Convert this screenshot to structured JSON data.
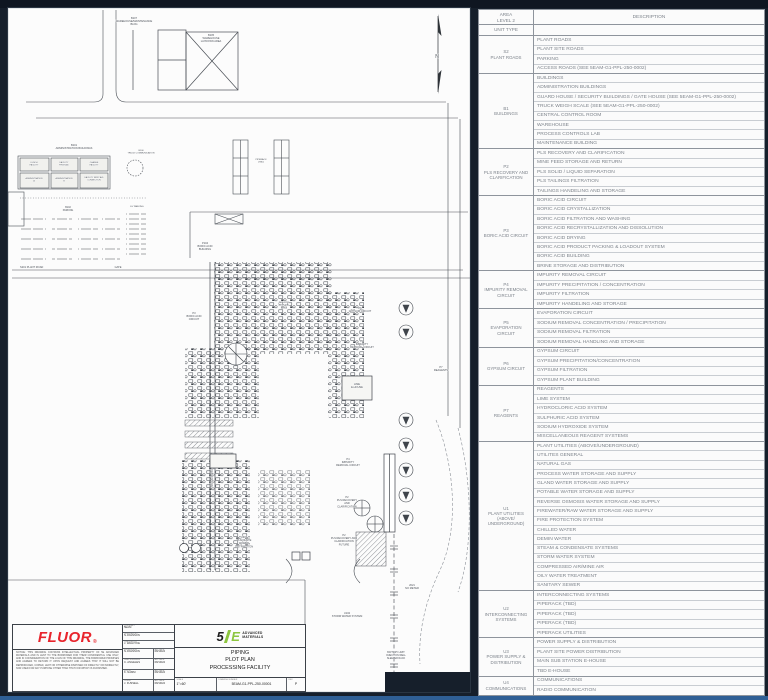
{
  "colors": {
    "background": "#161f2b",
    "sheet": "#fcfcfc",
    "bottom_accent": "#2f5f95",
    "fluor_red": "#e8242c",
    "logo_green": "#8dc63f"
  },
  "legend": {
    "header": {
      "area_line1": "AREA",
      "area_line2": "LEVEL 2",
      "unit_type": "UNIT TYPE",
      "description": "DESCRIPTION"
    },
    "groups": [
      {
        "code": "S2",
        "name": "PLANT ROADS",
        "items": [
          "PLANT ROADS",
          "PLANT SITE ROADS",
          "PARKING",
          "ACCESS ROADS (SEE 5EAM-G1-PPL-250-0002)"
        ]
      },
      {
        "code": "B1",
        "name": "BUILDINGS",
        "items": [
          "BUILDINGS",
          "ADMINISTRATION BUILDINGS",
          "GUARD HOUSE / SECURITY BUILDINGS / GATE HOUSE (SEE 5EAM-G1-PPL-250-0002)",
          "TRUCK WEIGH SCALE (SEE 5EAM-G1-PPL-250-0002)",
          "CENTRAL CONTROL ROOM",
          "WAREHOUSE",
          "PROCESS CONTROLS LAB",
          "MAINTENANCE BUILDING"
        ]
      },
      {
        "code": "P2",
        "name": "PLS RECOVERY AND CLARIFICATION",
        "items": [
          "PLS RECOVERY AND CLARIFICATION",
          "MINE FEED STORAGE AND RETURN",
          "PLS SOLID / LIQUID SEPARATION",
          "PLS TAILINGS FILTRATION",
          "TAILINGS HANDELING AND STORAGE"
        ]
      },
      {
        "code": "P3",
        "name": "BORIC ACID CIRCUIT",
        "items": [
          "BORIC ACID CIRCUIT",
          "BORIC ACID CRYSTALLIZATION",
          "BORIC ACID FILTRATION AND WASHING",
          "BORIC ACID RECRYSTALLIZATION AND DISSOLUTION",
          "BORIC ACID DRYING",
          "BORIC ACID PRODUCT PACKING & LOADOUT SYSTEM",
          "BORIC ACID BUILDING",
          "BRINE STORAGE AND DISTRIBUTION"
        ]
      },
      {
        "code": "P4",
        "name": "IMPURITY REMOVAL CIRCUIT",
        "items": [
          "IMPURITY REMOVAL CIRCUIT",
          "IMPURITY PRECIPITATION / CONCENTRATION",
          "IMPURITY FILTRATION",
          "IMPURITY HANDELING AND STORAGE"
        ]
      },
      {
        "code": "P5",
        "name": "EVAPORATION CIRCUIT",
        "items": [
          "EVAPORATION CIRCUIT",
          "SODIUM REMOVAL CONCENTRATION / PRECIPITATION",
          "SODIUM REMOVAL FILTRATION",
          "SODIUM REMOVAL HANDLING AND STORAGE"
        ]
      },
      {
        "code": "P6",
        "name": "GYPSUM CIRCUIT",
        "items": [
          "GYPSUM CIRCUIT",
          "GYPSUM PRECIPITATION/CONCENTRATION",
          "GYPSUM FILTRATION",
          "GYPSUM PLANT BUILDING"
        ]
      },
      {
        "code": "P7",
        "name": "REAGENTS",
        "items": [
          "REAGENTS",
          "LIME SYSTEM",
          "HYDROCLORIC ACID SYSTEM",
          "SULPHURIC ACID SYSTEM",
          "SODIUM HYDROXIDE SYSTEM",
          "MISCELLANEOUS REAGENT SYSTEMS"
        ]
      },
      {
        "code": "U1",
        "name": "PLANT UTILITIES (ABOVE/ UNDERGROUND)",
        "items": [
          "PLANT UTILITIES (ABOVE/UNDERGROUND)",
          "UTILITES GENERAL",
          "NATURAL GAS",
          "PROCESS WATER STORAGE AND SUPPLY",
          "GLAND WATER STORAGE AND SUPPLY",
          "POTABLE WATER STORAGE AND SUPPLY",
          "REVERSE OSMOSIS WATER STORAGE AND SUPPLY",
          "FIREWATER/RAW WATER STORAGE AND SUPPLY",
          "FIRE PROTECTION SYSTEM",
          "CHILLED WATER",
          "DEMIN WATER",
          "STEAM & CONDENSATE SYSTEMS",
          "STORM WATER SYSTEM",
          "COMPRESSED AIR/MINE AIR",
          "OILY WATER TREATMENT",
          "SANITARY SEWER"
        ]
      },
      {
        "code": "U2",
        "name": "INTERCONNECTING SYSTEMS",
        "items": [
          "INTERCONNECTING SYSTEMS",
          "PIPERACK (TBD)",
          "PIPERACK (TBD)",
          "PIPERACK  (TBD)",
          "PIPERACK UTILITIES"
        ]
      },
      {
        "code": "U3",
        "name": "POWER SUPPLY & DISTRIBUTION",
        "items": [
          "POWER SUPPLY & DISTRIBUTION",
          "PLANT SITE POWER DISTRIBUTION",
          "MAIN SUB STATION E-HOUSE",
          "TBD E-HOUSE"
        ]
      },
      {
        "code": "U4",
        "name": "COMMUNICATIONS",
        "items": [
          "COMMUNICATIONS",
          "RADIO COMMUNICATION"
        ]
      }
    ]
  },
  "title_block": {
    "fluor_logo": "FLUOR",
    "fluor_mark": "®",
    "notice": "NOTICE: THIS DRAWING CONTAINS INTELLECTUAL PROPERTY OF 5E ADVANCED MATERIALS AND IS LENT TO THE BORROWER FOR THEIR CONFIDENTIAL USE ONLY, AND IN CONSIDERATION OF THE LOAN OF THIS DRAWING, THE BORROWER PROMISES AND AGREES TO RETURN IT UPON REQUEST AND AGREES THAT IT WILL NOT BE REPRODUCED, COPIED, LENT OR OTHERWISE DISPOSED OF DIRECTLY OR INDIRECTLY, NOR USED FOR ANY PURPOSE OTHER THAN THAT FOR WHICH IS FURNISHED.",
    "contract_label": "CONTRACT",
    "contract_value": "5EAM",
    "designed_label": "DESIGNED BY",
    "designed_value": "N.JOHNSON",
    "checked_label": "CHECKED BY",
    "checked_value": "J. WALDYKE",
    "approvals": [
      {
        "role": "SUPERVISOR",
        "name": "N.JOHNSON",
        "date_label": "APP DATE",
        "date": "08/19/24"
      },
      {
        "role": "LEAD ENGINEER",
        "name": "C. ANGELES",
        "date_label": "APP DATE",
        "date": "08/19/24"
      },
      {
        "role": "FLUOR",
        "name": "K. NAMM",
        "date_label": "APP DATE",
        "date": "08/19/24"
      },
      {
        "role": "CLIENT",
        "name": "J. FUSSELL",
        "date_label": "APP DATE",
        "date": "08/19/24"
      }
    ],
    "logo_5": "5",
    "logo_E": "E",
    "logo_adv_line1": "ADVANCED",
    "logo_adv_line2": "MATERIALS",
    "title_line1": "PIPING",
    "title_line2": "PLOT PLAN",
    "title_line3": "PROCESSING FACILITY",
    "scale_label": "SCALE",
    "scale_value": "1\"=60'",
    "number_label": "DRAWING NUMBER",
    "number_value": "5EAM-G1-PPL-250-00001",
    "rev_label": "REV",
    "rev_value": "P"
  },
  "drawing": {
    "labels": [
      {
        "x": 126,
        "y": 11,
        "s": 2.6,
        "lines": [
          "B107",
          "WAREHOUSE/MAINTENANCE",
          "BLDG"
        ]
      },
      {
        "x": 203,
        "y": 28,
        "s": 2.6,
        "lines": [
          "B105",
          "WAREHOUSE",
          "LAYDOWN AREA"
        ]
      },
      {
        "x": 66,
        "y": 138,
        "s": 2.6,
        "lines": [
          "B101",
          "ADMINISTRATION BUILDINGS"
        ]
      },
      {
        "x": 26,
        "y": 155,
        "s": 2,
        "lines": [
          "LUNCH",
          "FACILITY"
        ]
      },
      {
        "x": 56,
        "y": 155,
        "s": 2,
        "lines": [
          "FACILITY",
          "FIRST AID"
        ]
      },
      {
        "x": 86,
        "y": 155,
        "s": 2,
        "lines": [
          "CHANGE",
          "FACILITY"
        ]
      },
      {
        "x": 26,
        "y": 171,
        "s": 2,
        "lines": [
          "ADMINISTRATION",
          "A"
        ]
      },
      {
        "x": 56,
        "y": 171,
        "s": 2,
        "lines": [
          "ADMINISTRATION",
          "B"
        ]
      },
      {
        "x": 86,
        "y": 170,
        "s": 2,
        "lines": [
          "FACILITY FIRST AID",
          "CONNECTION"
        ]
      },
      {
        "x": 133,
        "y": 143,
        "s": 2.2,
        "lines": [
          "B106",
          "TRUCK COMMUNICATION"
        ]
      },
      {
        "x": 129,
        "y": 199,
        "s": 2.2,
        "lines": [
          "EV PARKING"
        ]
      },
      {
        "x": 60,
        "y": 200,
        "s": 2.4,
        "lines": [
          "B102",
          "PARKING"
        ]
      },
      {
        "x": 12,
        "y": 260,
        "s": 2.6,
        "anchor": "start",
        "lines": [
          "S201 PLANT ROAD"
        ]
      },
      {
        "x": 110,
        "y": 260,
        "s": 2.6,
        "lines": [
          "GATE"
        ]
      },
      {
        "x": 253,
        "y": 152,
        "s": 2.2,
        "lines": [
          "PIPERACK",
          "(TBD)"
        ]
      },
      {
        "x": 197,
        "y": 236,
        "s": 2.6,
        "lines": [
          "P104",
          "BORIC ACID",
          "BUILDING"
        ]
      },
      {
        "x": 186,
        "y": 306,
        "s": 2.6,
        "lines": [
          "P3",
          "BORIC ACID",
          "CIRCUIT"
        ]
      },
      {
        "x": 276,
        "y": 295,
        "s": 2.2,
        "lines": [
          "IMPURITY",
          "REMOVAL",
          "AREA"
        ]
      },
      {
        "x": 352,
        "y": 301,
        "s": 2.6,
        "lines": [
          "P6",
          "GYPSUM CIRCUIT"
        ]
      },
      {
        "x": 354,
        "y": 334,
        "s": 2.6,
        "lines": [
          "P4",
          "IMPURITY",
          "REMOVAL CIRCUIT"
        ]
      },
      {
        "x": 340,
        "y": 452,
        "s": 2.6,
        "lines": [
          "P4",
          "IMPURITY",
          "REMOVAL CIRCUIT"
        ]
      },
      {
        "x": 339,
        "y": 490,
        "s": 2.6,
        "lines": [
          "P2",
          "PLS RECOVERY",
          "AND",
          "CLARIFICATION"
        ]
      },
      {
        "x": 336,
        "y": 528,
        "s": 2.6,
        "lines": [
          "P2",
          "PLS RECOVERY AND",
          "CLARIFICATION",
          "FUTURE"
        ]
      },
      {
        "x": 236,
        "y": 530,
        "s": 2.6,
        "lines": [
          "U301",
          "PLANT SITE",
          "POWER",
          "DISTRIBUTION"
        ]
      },
      {
        "x": 339,
        "y": 606,
        "s": 2.6,
        "lines": [
          "U102",
          "STORM WATER SYSTEM"
        ]
      },
      {
        "x": 404,
        "y": 578,
        "s": 2.6,
        "lines": [
          "2021",
          "NO METER"
        ]
      },
      {
        "x": 388,
        "y": 645,
        "s": 2.4,
        "lines": [
          "BATTERY LIMIT",
          "INJECTION WELL",
          "SLEEPER RACK"
        ]
      },
      {
        "x": 349,
        "y": 377,
        "s": 2.6,
        "lines": [
          "LIME",
          "E-HOUSE"
        ]
      },
      {
        "x": 433,
        "y": 360,
        "s": 2.6,
        "lines": [
          "P7",
          "REAGENTS"
        ]
      },
      {
        "x": 205,
        "y": 470,
        "s": 2.4,
        "rotate": -90,
        "lines": [
          "PIPERACK (TBD)"
        ]
      },
      {
        "x": 429,
        "y": 50,
        "s": 5,
        "lines": [
          "N"
        ]
      }
    ]
  }
}
